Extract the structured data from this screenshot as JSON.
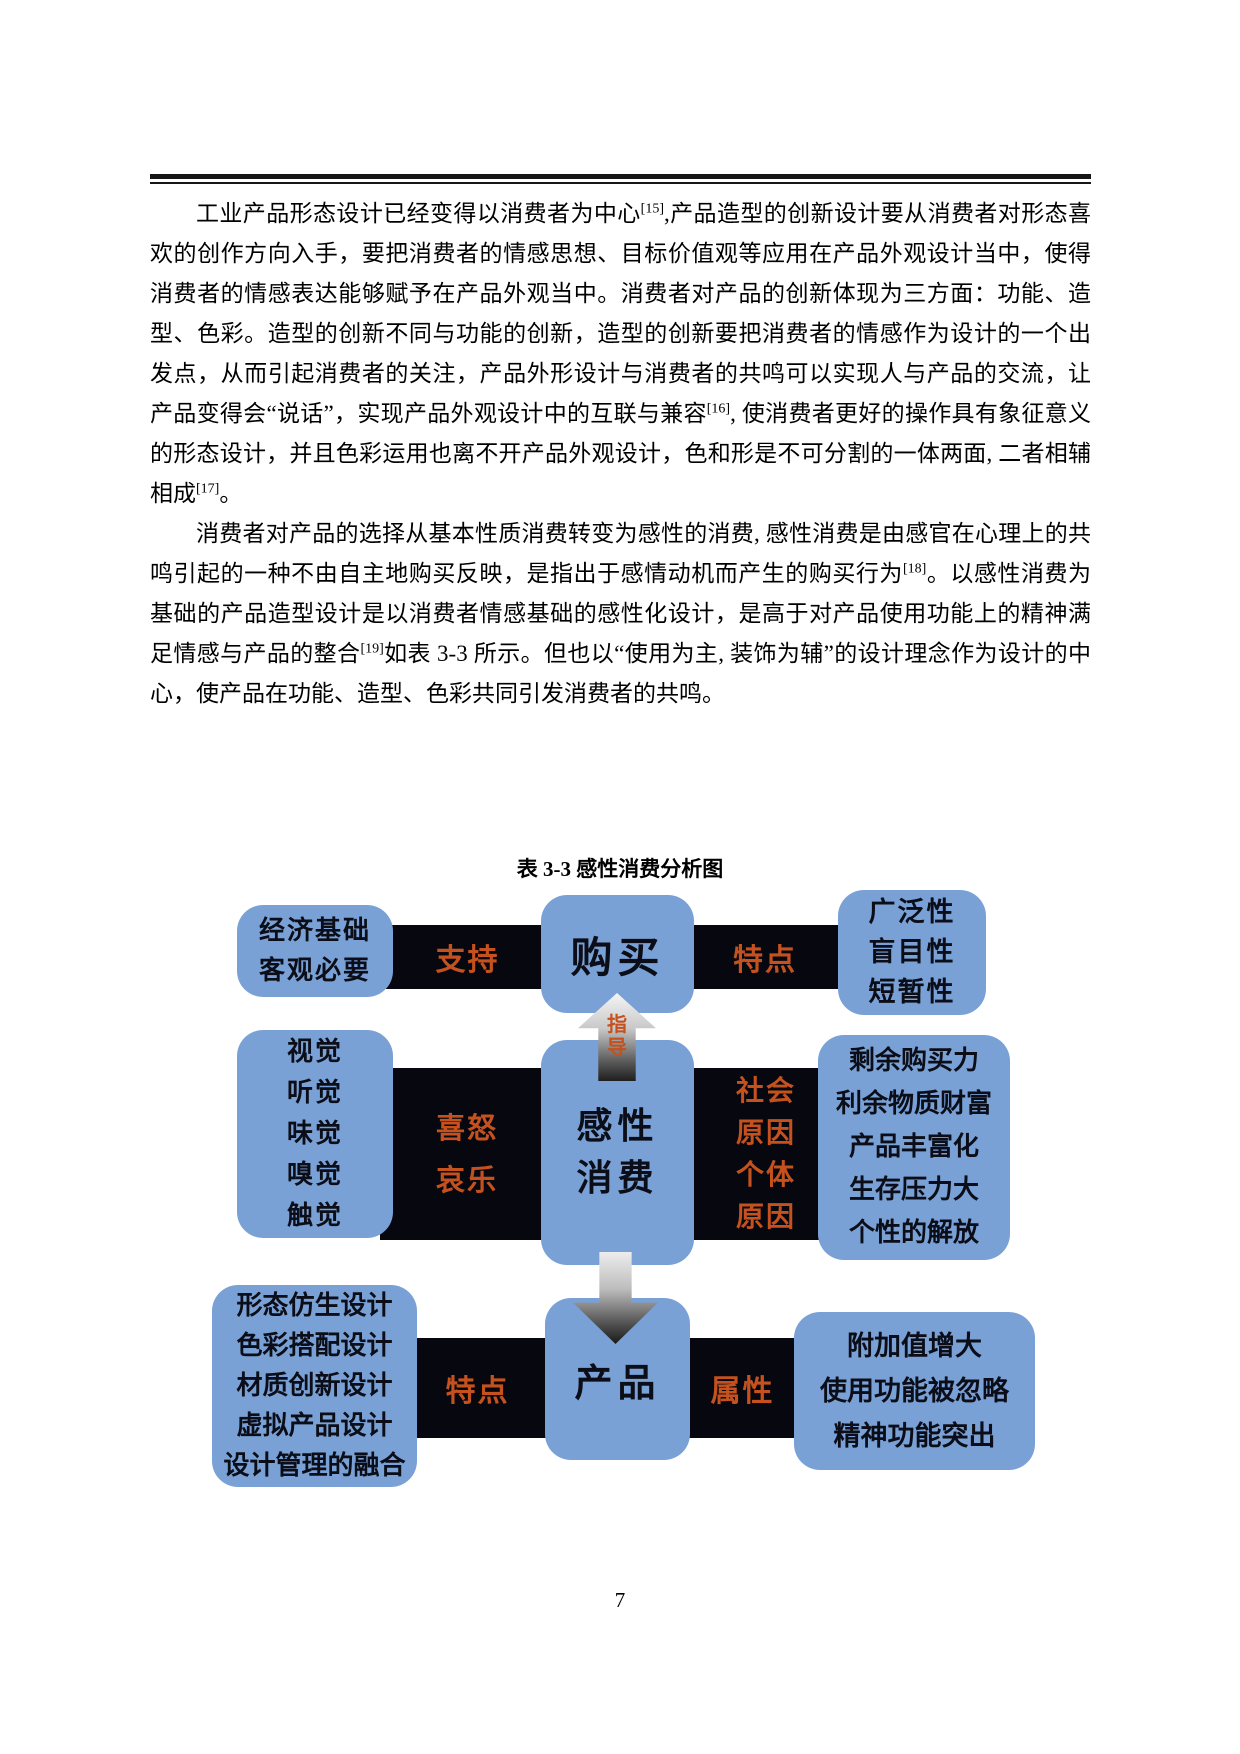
{
  "paragraphs": [
    {
      "segments": [
        {
          "text": "工业产品形态设计已经变得以消费者为中心"
        },
        {
          "text": "[15]",
          "sup": true
        },
        {
          "text": ",产品造型的创新设计要从消费者对形态喜欢的创作方向入手，要把消费者的情感思想、目标价值观等应用在产品外观设计当中，使得消费者的情感表达能够赋予在产品外观当中。消费者对产品的创新体现为三方面：功能、造型、色彩。造型的创新不同与功能的创新，造型的创新要把消费者的情感作为设计的一个出发点，从而引起消费者的关注，产品外形设计与消费者的共鸣可以实现人与产品的交流，让产品变得会“说话”，实现产品外观设计中的互联与兼容"
        },
        {
          "text": "[16]",
          "sup": true
        },
        {
          "text": ", 使消费者更好的操作具有象征意义的形态设计，并且色彩运用也离不开产品外观设计，色和形是不可分割的一体两面, 二者相辅相成"
        },
        {
          "text": "[17]",
          "sup": true
        },
        {
          "text": "。"
        }
      ]
    },
    {
      "segments": [
        {
          "text": "消费者对产品的选择从基本性质消费转变为感性的消费, 感性消费是由感官在心理上的共鸣引起的一种不由自主地购买反映，是指出于感情动机而产生的购买行为"
        },
        {
          "text": "[18]",
          "sup": true
        },
        {
          "text": "。以感性消费为基础的产品造型设计是以消费者情感基础的感性化设计，是高于对产品使用功能上的精神满足情感与产品的整合"
        },
        {
          "text": "[19]",
          "sup": true
        },
        {
          "text": "如表 3-3 所示。但也以“使用为主, 装饰为辅”的设计理念作为设计的中心，使产品在功能、造型、色彩共同引发消费者的共鸣。"
        }
      ]
    }
  ],
  "figure": {
    "caption": "表 3-3 感性消费分析图",
    "colors": {
      "box_blue": "#7AA1D5",
      "bar_black": "#06070F",
      "accent_orange": "#C4511E"
    },
    "row1": {
      "left_lines": [
        "经济基础",
        "客观必要"
      ],
      "left_bar": "支持",
      "center": "购买",
      "right_bar": "特点",
      "right_lines": [
        "广泛性",
        "盲目性",
        "短暂性"
      ]
    },
    "arrow_up_label_lines": [
      "指",
      "导"
    ],
    "row2": {
      "left_lines": [
        "视觉",
        "听觉",
        "味觉",
        "嗅觉",
        "触觉"
      ],
      "left_bar_lines": [
        "喜怒",
        "哀乐"
      ],
      "center_lines": [
        "感性",
        "消费"
      ],
      "right_bar_lines": [
        "社会",
        "原因",
        "个体",
        "原因"
      ],
      "right_lines": [
        "剩余购买力",
        "利余物质财富",
        "产品丰富化",
        "生存压力大",
        "个性的解放"
      ]
    },
    "row3": {
      "left_lines": [
        "形态仿生设计",
        "色彩搭配设计",
        "材质创新设计",
        "虚拟产品设计",
        "设计管理的融合"
      ],
      "left_bar": "特点",
      "center": "产品",
      "right_bar": "属性",
      "right_lines": [
        "附加值增大",
        "使用功能被忽略",
        "精神功能突出"
      ]
    }
  },
  "footer": {
    "page_number": "7"
  }
}
